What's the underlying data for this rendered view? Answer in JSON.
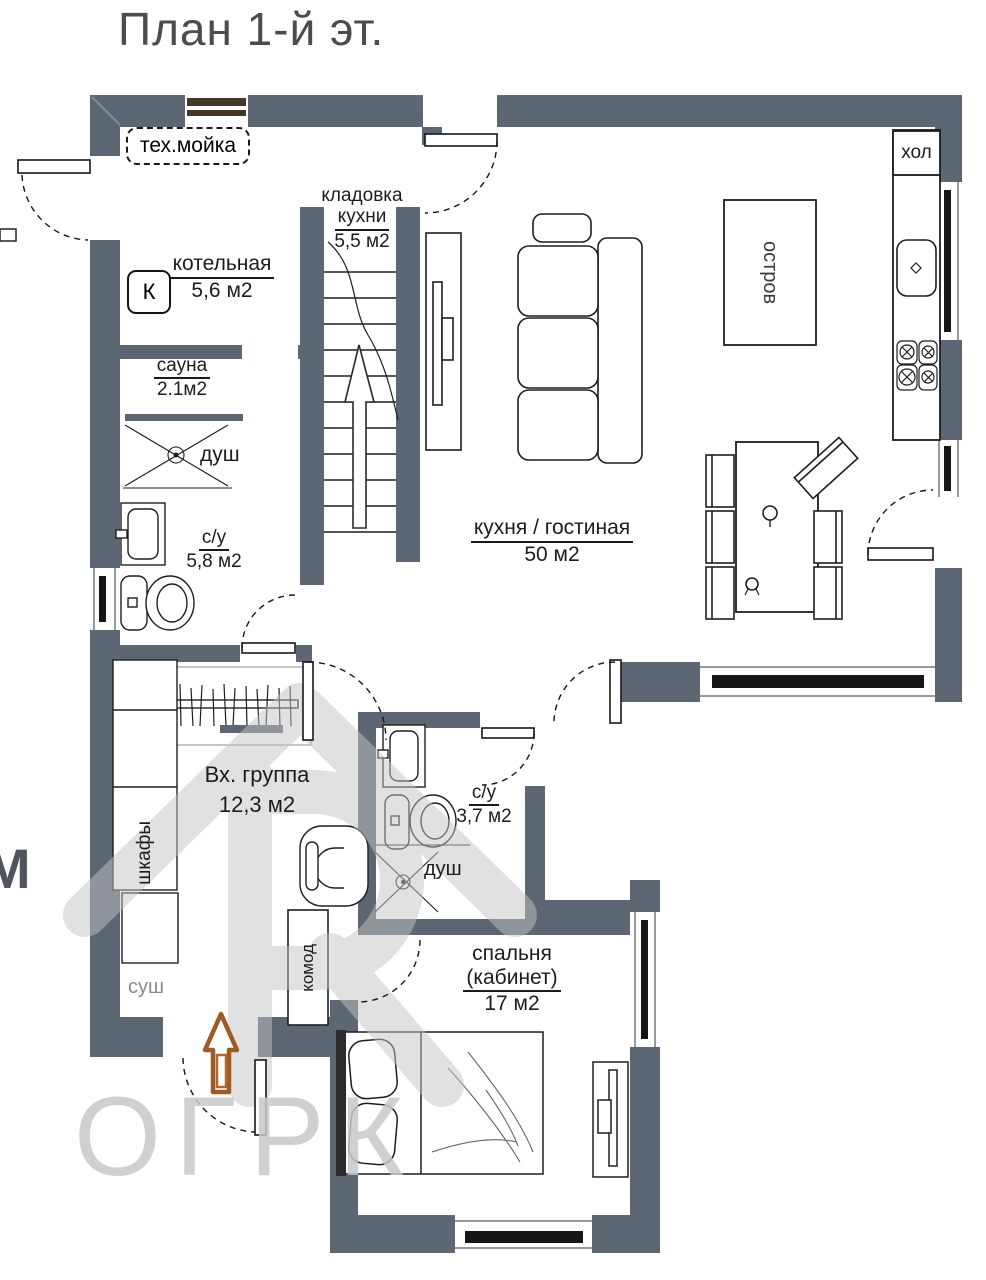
{
  "title": "План 1-й эт.",
  "colors": {
    "wall": "#5d6774",
    "arrow": "#9c5c26",
    "watermark": "#c8c8c8"
  },
  "rooms": {
    "tech": {
      "name": "тех.мойка"
    },
    "boiler": {
      "name": "котельная",
      "area": "5,6 м2",
      "marker": "К"
    },
    "pantry": {
      "name1": "кладовка",
      "name2": "кухни",
      "area": "5,5 м2"
    },
    "sauna": {
      "name": "сауна",
      "area": "2.1м2"
    },
    "shower_sauna": {
      "name": "душ"
    },
    "wc1": {
      "name": "с/у",
      "area": "5,8 м2"
    },
    "kitchen": {
      "name": "кухня / гостиная",
      "area": "50 м2"
    },
    "entry": {
      "name": "Вх. группа",
      "area": "12,3 м2"
    },
    "wc2": {
      "name": "с/у",
      "area": "3,7 м2"
    },
    "shower_wc2": {
      "name": "душ"
    },
    "bedroom": {
      "name1": "спальня",
      "name2": "(кабинет)",
      "area": "17 м2"
    }
  },
  "furniture": {
    "island": "остров",
    "fridge": "хол",
    "wardrobe": "шкафы",
    "dresser": "комод",
    "dryer": "суш"
  },
  "watermark": {
    "text": "ОГРК",
    "edge_letter": "М"
  }
}
